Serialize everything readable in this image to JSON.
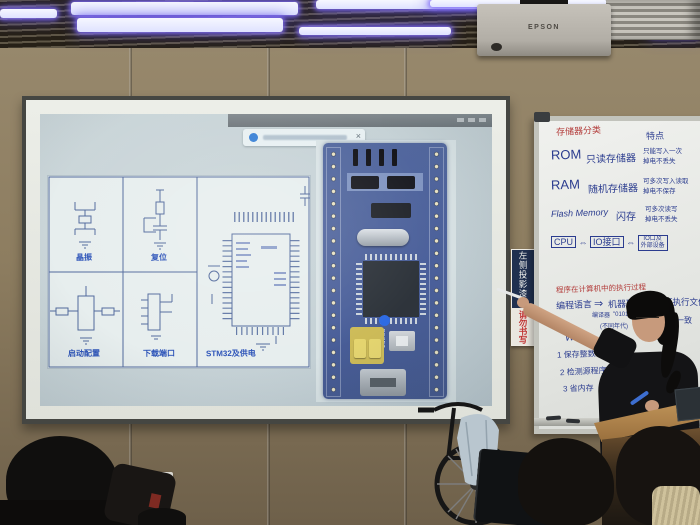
{
  "projector": {
    "brand": "EPSON"
  },
  "sign": {
    "top": "左侧投影漆面",
    "bottom": "请勿书写"
  },
  "screen": {
    "toast_close": "×",
    "schematic_labels": {
      "crystal": "晶振",
      "reset": "复位",
      "boot": "启动配置",
      "download": "下载端口",
      "mcu": "STM32及供电"
    },
    "pcb": {
      "reset": "RESET"
    }
  },
  "whiteboard": {
    "title": "存储器分类",
    "col_header": "特点",
    "rows": [
      {
        "abbr": "ROM",
        "name": "只读存储器",
        "note1": "只能写入一次",
        "note2": "掉电不丢失"
      },
      {
        "abbr": "RAM",
        "name": "随机存储器",
        "note1": "可多次写入读取",
        "note2": "掉电不保存"
      },
      {
        "abbr": "Flash Memory",
        "name": "闪存",
        "note1": "可多次读写",
        "note2": "掉电不丢失"
      }
    ],
    "bus": {
      "cpu": "CPU",
      "arrow": "⇔",
      "io": "IO接口",
      "dev1": "IO口及",
      "dev2": "外部设备"
    },
    "lower": {
      "red_title": "程序在计算机中的执行过程",
      "src": "编程语言",
      "arrow": "⇒",
      "mid": "机器码",
      "dst": "可执行文件",
      "note_arrow": "编译器",
      "note_mid": "\"0101\"",
      "note_mid2": "(不同年代)",
      "side": "一致",
      "why": "Why",
      "item1": "1 保存整数",
      "item2": "2 检测源程序",
      "item3": "3 省内存"
    }
  }
}
